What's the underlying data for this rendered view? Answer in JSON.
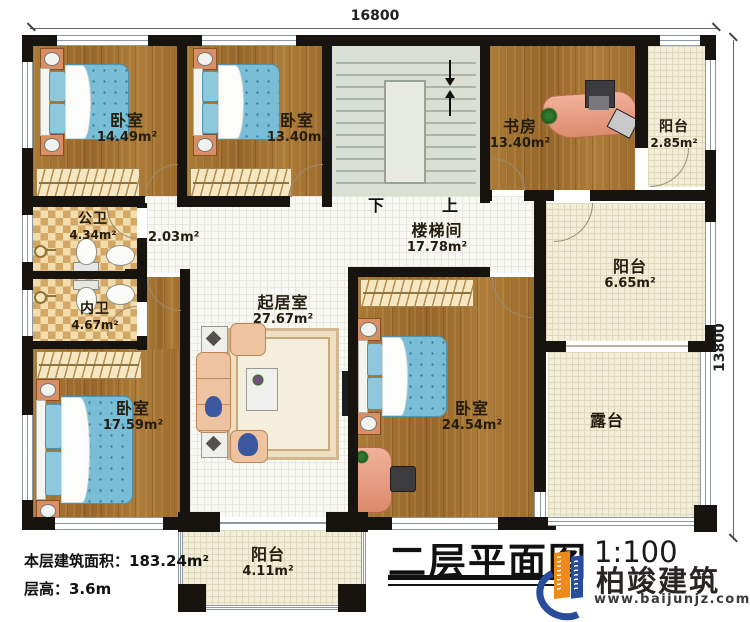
{
  "dimensions": {
    "width_mm": "16800",
    "height_mm": "13800"
  },
  "rooms": {
    "bedroom_nw": {
      "name": "卧室",
      "area": "14.49m²"
    },
    "bedroom_n": {
      "name": "卧室",
      "area": "13.40m²"
    },
    "study": {
      "name": "书房",
      "area": "13.40m²"
    },
    "balcony_ne": {
      "name": "阳台",
      "area": "2.85m²"
    },
    "public_bath": {
      "name": "公卫",
      "area": "4.34m²"
    },
    "hall": {
      "area": "2.03m²"
    },
    "stairwell": {
      "name": "楼梯间",
      "area": "17.78m²"
    },
    "balcony_e": {
      "name": "阳台",
      "area": "6.65m²"
    },
    "private_bath": {
      "name": "内卫",
      "area": "4.67m²"
    },
    "living": {
      "name": "起居室",
      "area": "27.67m²"
    },
    "bedroom_sw": {
      "name": "卧室",
      "area": "17.59m²"
    },
    "bedroom_se": {
      "name": "卧室",
      "area": "24.54m²"
    },
    "terrace": {
      "name": "露台"
    },
    "balcony_s": {
      "name": "阳台",
      "area": "4.11m²"
    }
  },
  "stairs": {
    "down_label": "下",
    "up_label": "上"
  },
  "info": {
    "floor_area_line": "本层建筑面积：183.24m²",
    "floor_height_line": "层高：3.6m"
  },
  "title_block": {
    "title": "二层平面图",
    "scale": "1:100"
  },
  "brand": {
    "name": "柏竣建筑",
    "website": "www.baijunjz.com"
  },
  "colors": {
    "wall": "#17130e",
    "wood": "#a1702d",
    "bed": "#79bed6",
    "brand_blue": "#2a4d9b",
    "brand_orange": "#ef8a18"
  }
}
